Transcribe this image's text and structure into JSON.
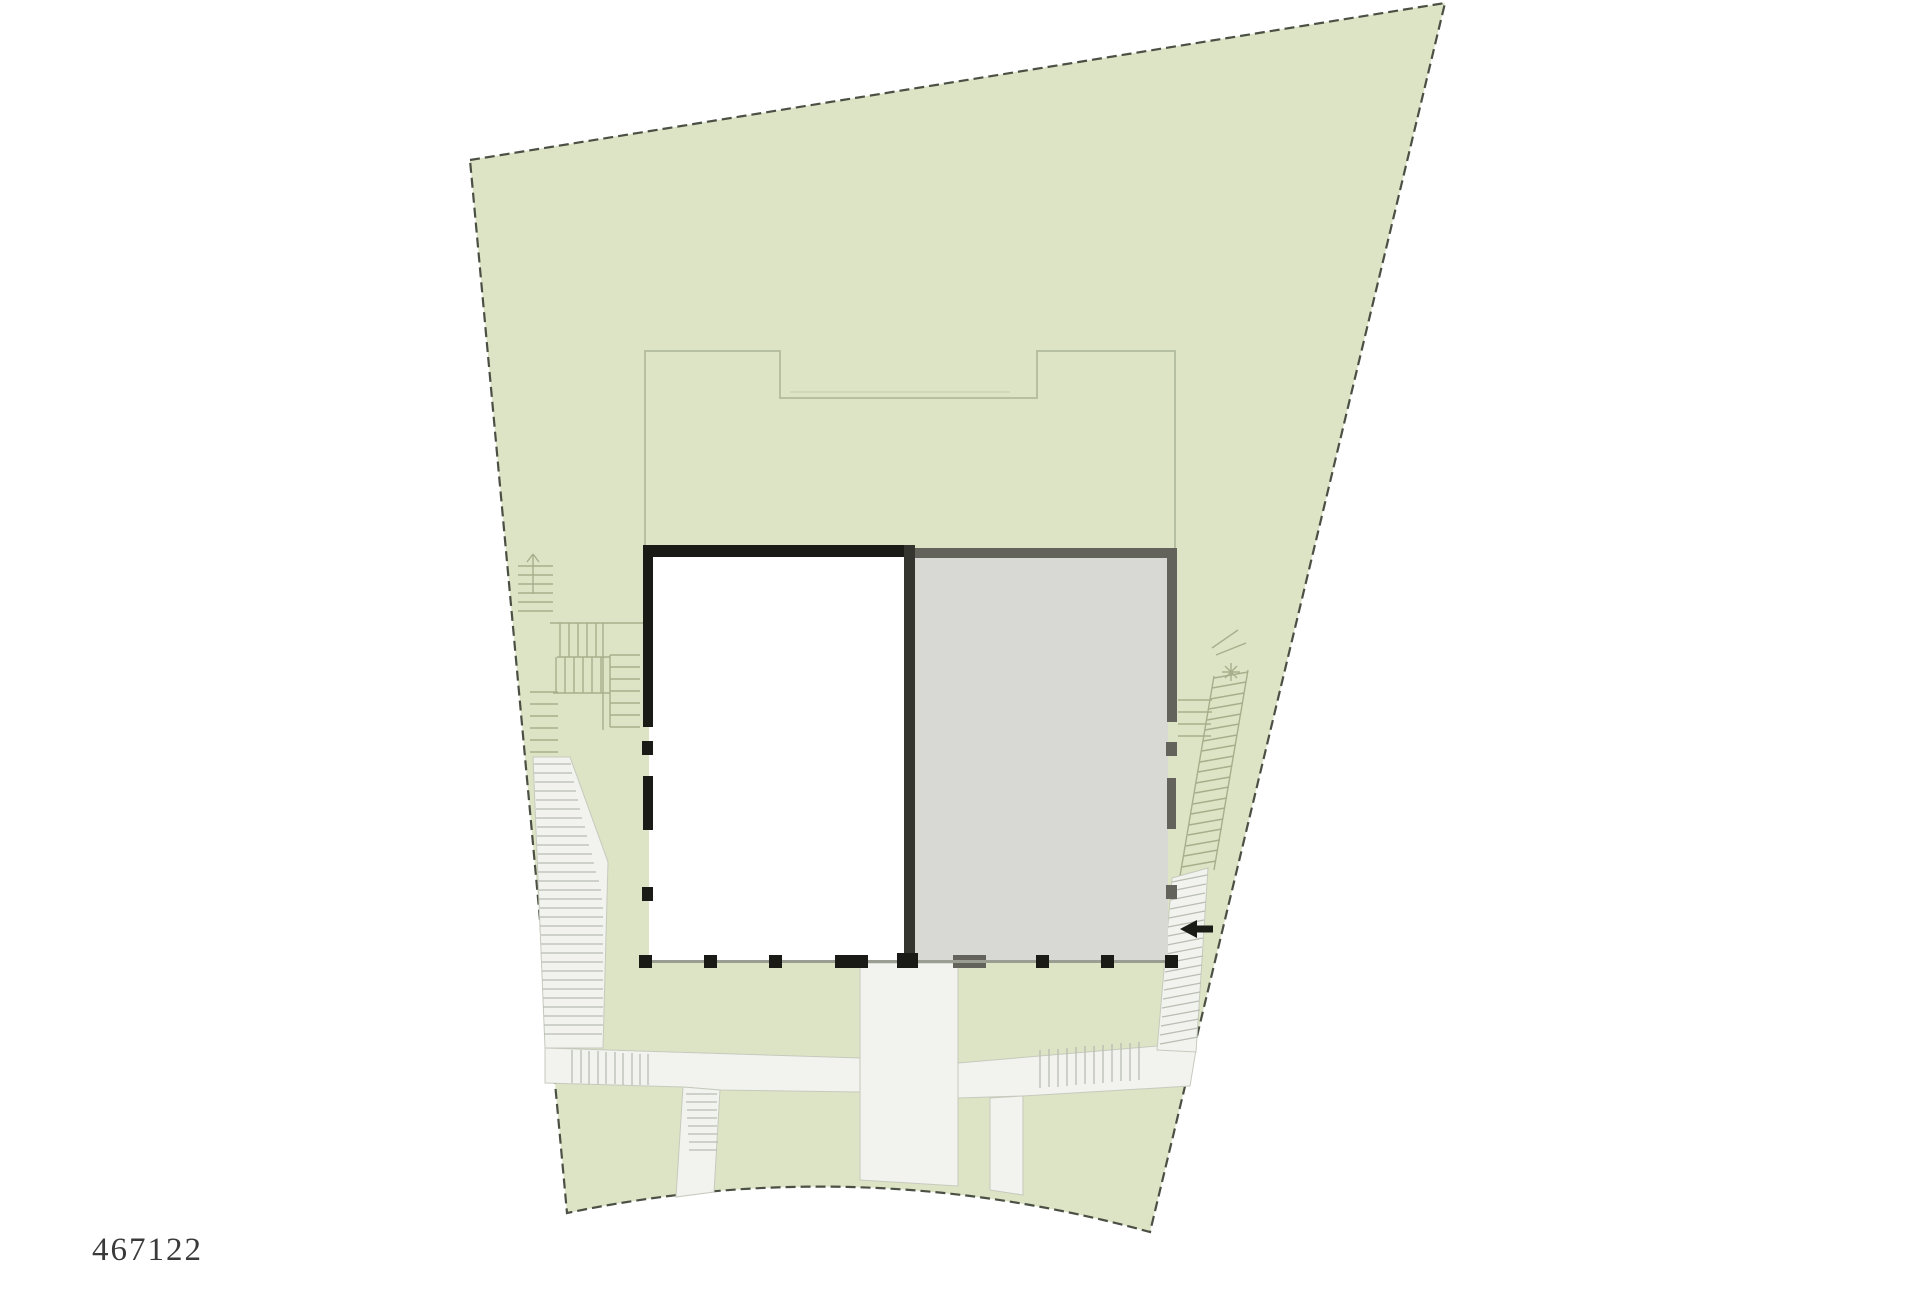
{
  "plan": {
    "label": "467122",
    "colors": {
      "page_bg": "#ffffff",
      "parcel_fill": "#dce4c5",
      "boundary": "#4b5044",
      "roof_line": "#b7bfa3",
      "steps_line": "#a6ae8c",
      "path_fill": "#f2f3ef",
      "path_edge": "#c6cabd",
      "hatch_line": "#b9bdb2",
      "building_white_fill": "#ffffff",
      "building_black": "#1a1a17",
      "building_gray_fill": "#d8d8d4",
      "building_gray_border": "#63635b",
      "divider": "#35352f",
      "base_line": "#9a9e92",
      "arrow": "#1a1a17"
    },
    "icons": {
      "entrance_arrow": "left-arrow",
      "left_stair_marker": "stair-direction-marker",
      "right_stair_marker": "survey-star-marker"
    }
  }
}
